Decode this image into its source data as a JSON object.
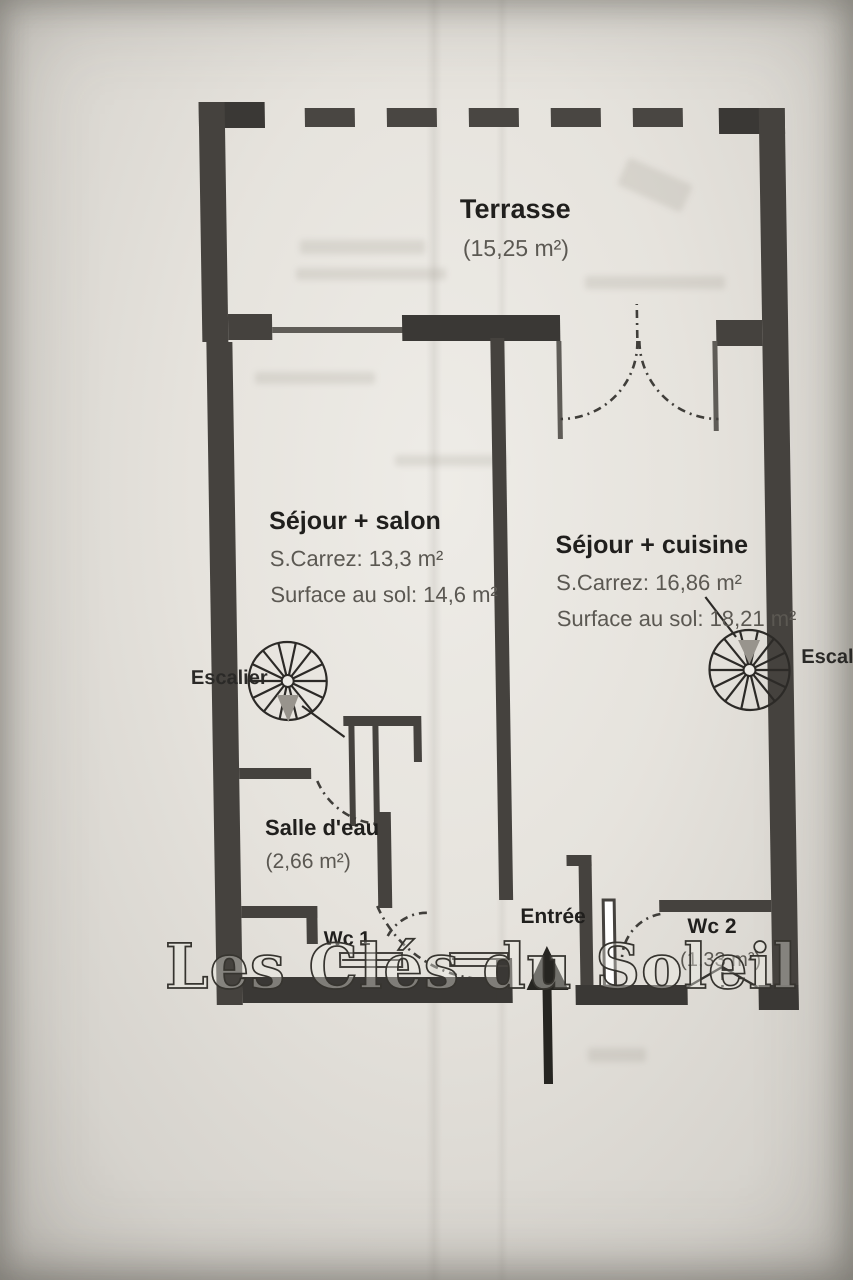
{
  "photo": {
    "watermark": "Les Clés du Soleil"
  },
  "plan": {
    "terrasse": {
      "name": "Terrasse",
      "area": "(15,25 m²)"
    },
    "sejour_salon": {
      "name": "Séjour + salon",
      "carrez": "S.Carrez: 13,3 m²",
      "surface": "Surface au sol: 14,6 m²"
    },
    "sejour_cuisine": {
      "name": "Séjour + cuisine",
      "carrez": "S.Carrez: 16,86 m²",
      "surface": "Surface au sol: 18,21 m²"
    },
    "salle_eau": {
      "name": "Salle d'eau",
      "area": "(2,66 m²)"
    },
    "wc1": {
      "name": "Wc 1"
    },
    "wc2": {
      "name": "Wc 2",
      "area": "(1,33 m²)"
    },
    "entree": {
      "name": "Entrée"
    },
    "escalier_left": {
      "label": "Escalier"
    },
    "escalier_right": {
      "label": "Escalier"
    }
  },
  "colors": {
    "wall": "#45423e",
    "room_name_text": "#201f1d",
    "area_text": "#5b5852",
    "paper": "#e6e3dd"
  }
}
